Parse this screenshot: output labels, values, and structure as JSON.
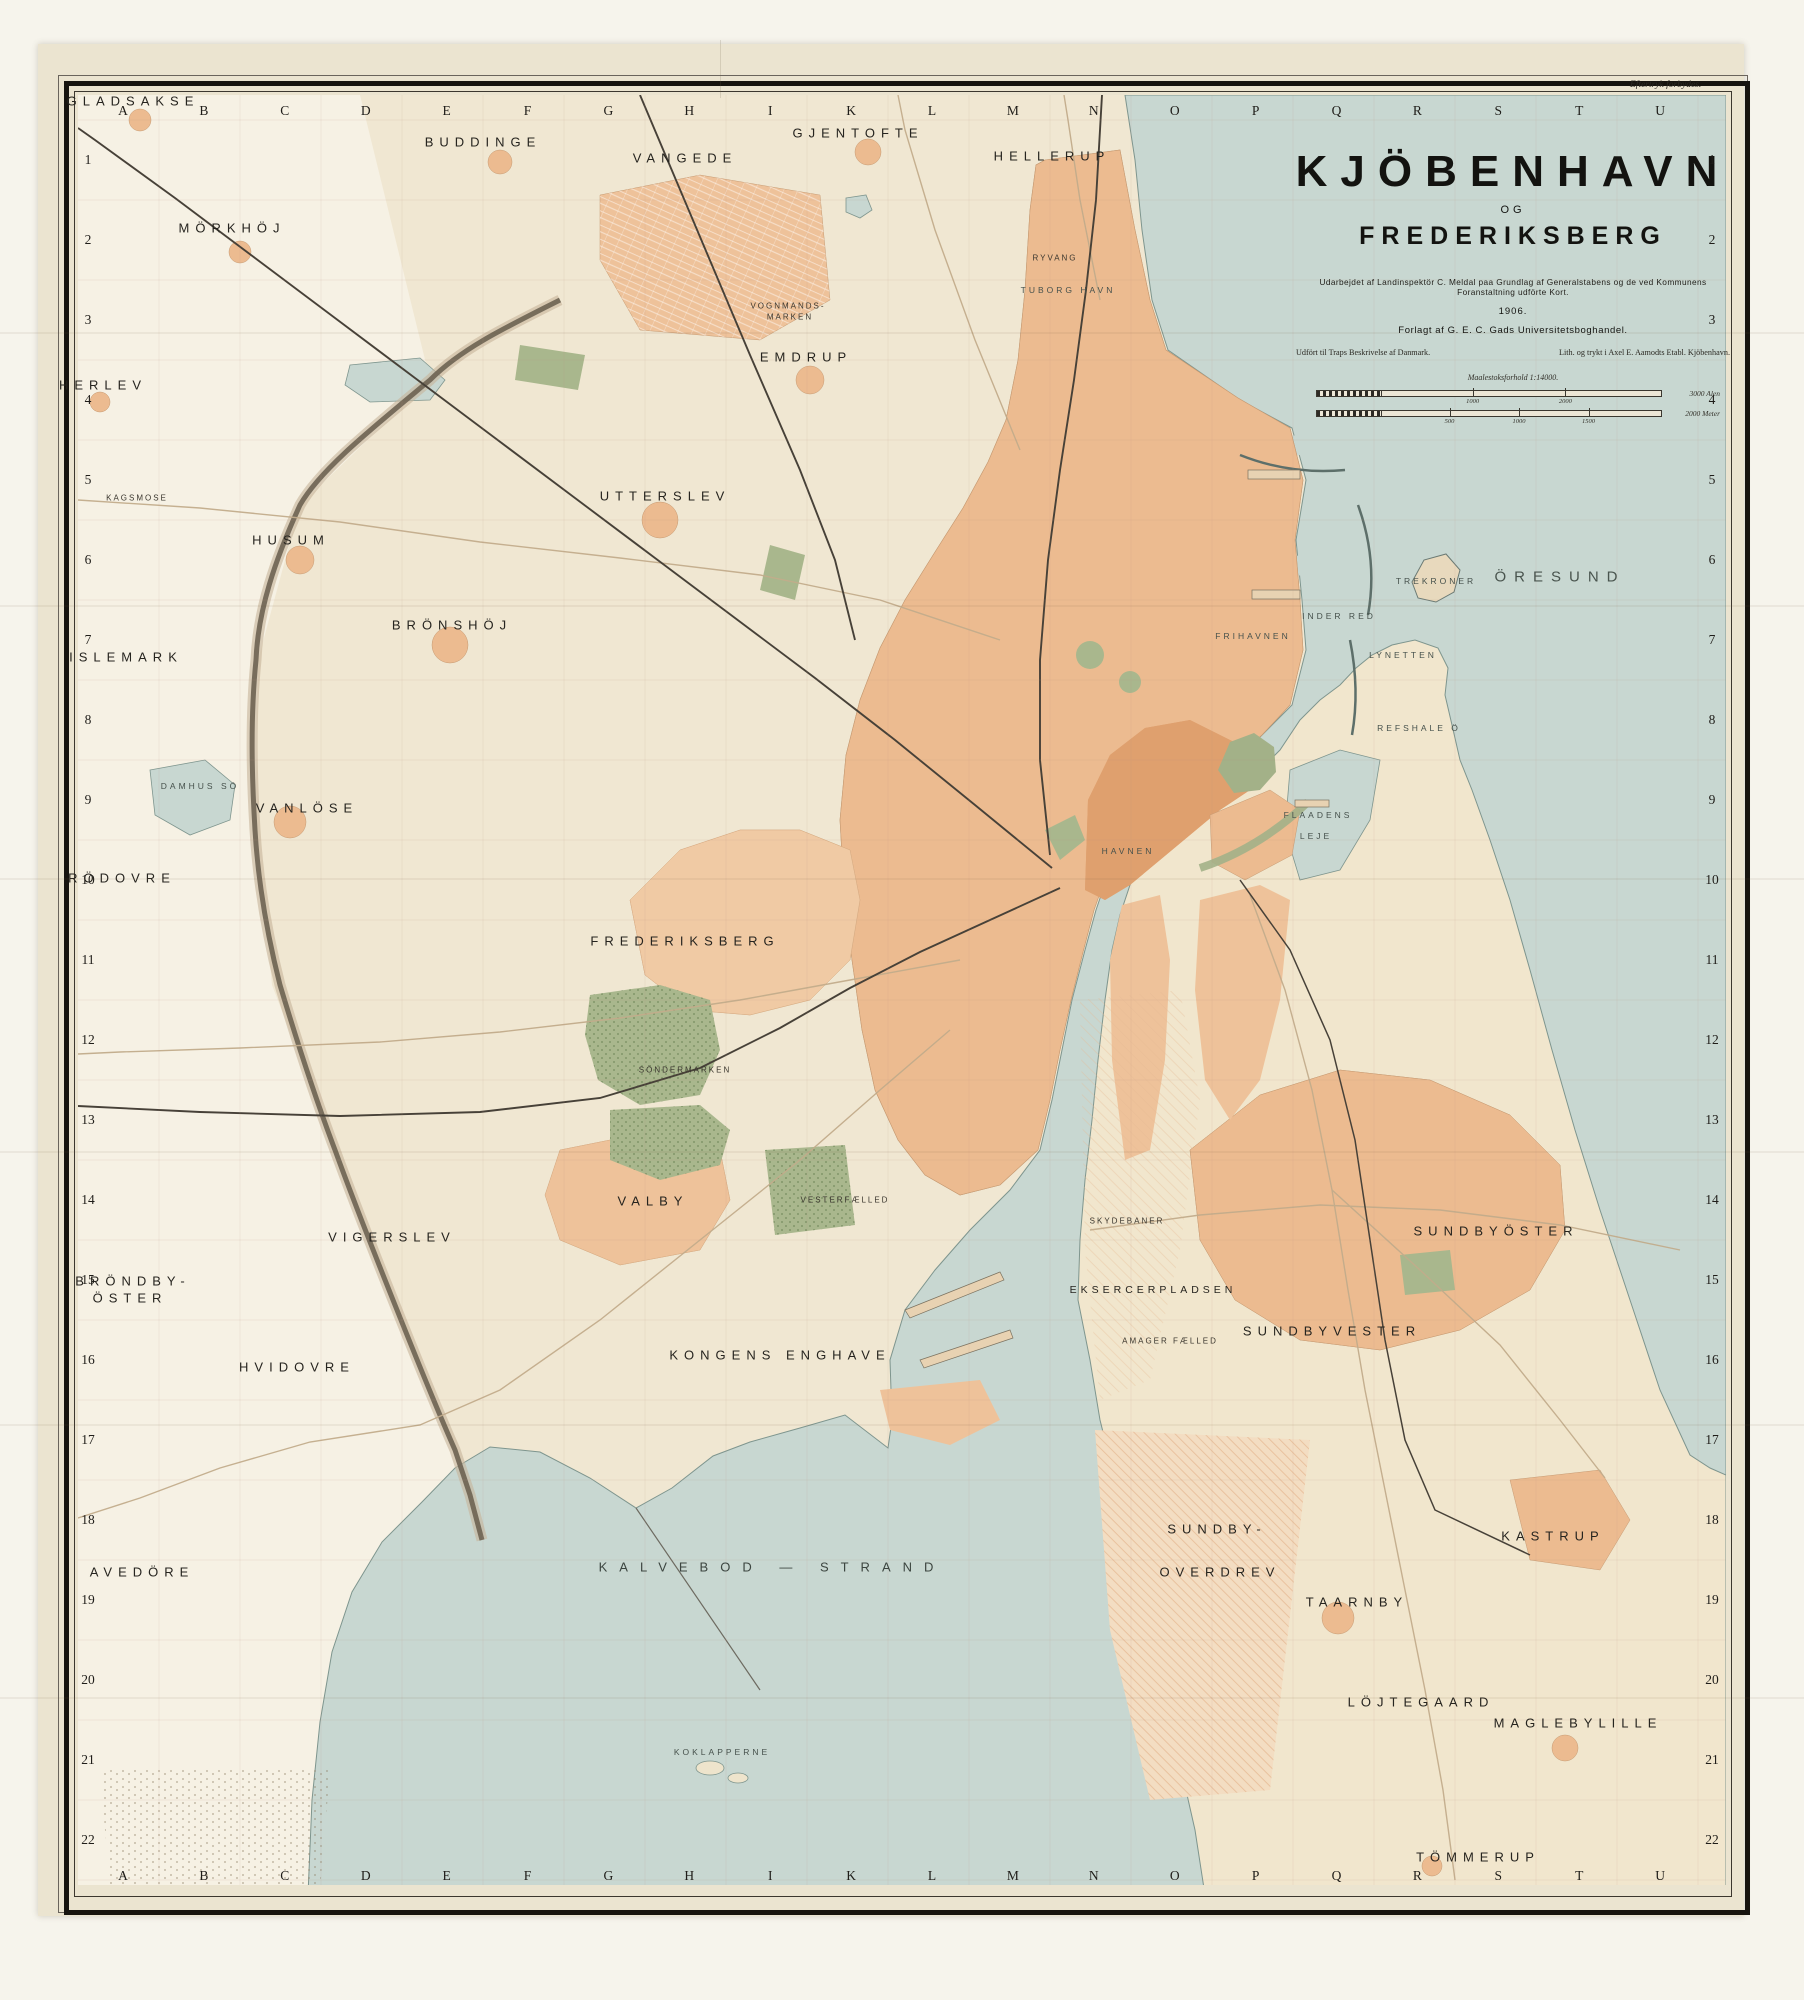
{
  "page": {
    "imprint_top_right": "Eftertryk forbydes."
  },
  "title_block": {
    "title": "KJÖBENHAVN",
    "conjunction": "OG",
    "subtitle": "FREDERIKSBERG",
    "credit_line": "Udarbejdet af Landinspektör C. Meldal paa Grundlag af Generalstabens og de ved Kommunens Foranstaltning udförte Kort.",
    "year": "1906.",
    "publisher": "Forlagt af G. E. C. Gads Universitetsboghandel.",
    "note_left": "Udfört til Traps Beskrivelse af Danmark.",
    "note_right": "Lith. og trykt i Axel E. Aamodts Etabl. Kjöbenhavn.",
    "scale_caption": "Maalestoksforhold 1:14000.",
    "scale_bars": [
      {
        "ticks": [
          "1000",
          "2000"
        ],
        "end_label": "3000 Alen"
      },
      {
        "ticks": [
          "500",
          "1000",
          "1500"
        ],
        "end_label": "2000 Meter"
      }
    ]
  },
  "map": {
    "grid_letters": [
      "A",
      "B",
      "C",
      "D",
      "E",
      "F",
      "G",
      "H",
      "I",
      "K",
      "L",
      "M",
      "N",
      "O",
      "P",
      "Q",
      "R",
      "S",
      "T",
      "U"
    ],
    "row_numbers": [
      "1",
      "2",
      "3",
      "4",
      "5",
      "6",
      "7",
      "8",
      "9",
      "10",
      "11",
      "12",
      "13",
      "14",
      "15",
      "16",
      "17",
      "18",
      "19",
      "20",
      "21",
      "22"
    ],
    "labels": [
      {
        "t": "GLADSAKSE",
        "x": 133,
        "y": 101,
        "c": "lg"
      },
      {
        "t": "BUDDINGE",
        "x": 483,
        "y": 142,
        "c": "lg"
      },
      {
        "t": "VANGEDE",
        "x": 685,
        "y": 158,
        "c": "lg"
      },
      {
        "t": "GJENTOFTE",
        "x": 858,
        "y": 133,
        "c": "lg"
      },
      {
        "t": "HELLERUP",
        "x": 1052,
        "y": 156,
        "c": "lg"
      },
      {
        "t": "MÖRKHÖJ",
        "x": 232,
        "y": 228,
        "c": "lg"
      },
      {
        "t": "EMDRUP",
        "x": 806,
        "y": 357,
        "c": "lg"
      },
      {
        "t": "HERLEV",
        "x": 103,
        "y": 385,
        "c": "lg"
      },
      {
        "t": "UTTERSLEV",
        "x": 665,
        "y": 496,
        "c": "lg"
      },
      {
        "t": "HUSUM",
        "x": 291,
        "y": 540,
        "c": "lg"
      },
      {
        "t": "BRÖNSHÖJ",
        "x": 452,
        "y": 625,
        "c": "lg"
      },
      {
        "t": "ISLEMARK",
        "x": 126,
        "y": 657,
        "c": "lg"
      },
      {
        "t": "VANLÖSE",
        "x": 307,
        "y": 808,
        "c": "lg"
      },
      {
        "t": "RÖDOVRE",
        "x": 122,
        "y": 878,
        "c": "lg"
      },
      {
        "t": "FREDERIKSBERG",
        "x": 685,
        "y": 941,
        "c": "lg"
      },
      {
        "t": "VALBY",
        "x": 653,
        "y": 1201,
        "c": "lg"
      },
      {
        "t": "VIGERSLEV",
        "x": 392,
        "y": 1237,
        "c": "lg"
      },
      {
        "t": "BRÖNDBY-",
        "x": 133,
        "y": 1281,
        "c": "lg"
      },
      {
        "t": "ÖSTER",
        "x": 130,
        "y": 1298,
        "c": "lg"
      },
      {
        "t": "HVIDOVRE",
        "x": 297,
        "y": 1367,
        "c": "lg"
      },
      {
        "t": "KONGENS ENGHAVE",
        "x": 780,
        "y": 1355,
        "c": "lg"
      },
      {
        "t": "AVEDÖRE",
        "x": 142,
        "y": 1572,
        "c": "lg"
      },
      {
        "t": "EKSERCERPLADSEN",
        "x": 1153,
        "y": 1290,
        "c": "md"
      },
      {
        "t": "SUNDBYVESTER",
        "x": 1332,
        "y": 1331,
        "c": "lg"
      },
      {
        "t": "SUNDBYÖSTER",
        "x": 1496,
        "y": 1231,
        "c": "lg"
      },
      {
        "t": "SUNDBY-",
        "x": 1217,
        "y": 1529,
        "c": "lg"
      },
      {
        "t": "OVERDREV",
        "x": 1220,
        "y": 1572,
        "c": "lg"
      },
      {
        "t": "TAARNBY",
        "x": 1357,
        "y": 1602,
        "c": "lg"
      },
      {
        "t": "KASTRUP",
        "x": 1553,
        "y": 1536,
        "c": "lg"
      },
      {
        "t": "LÖJTEGAARD",
        "x": 1421,
        "y": 1702,
        "c": "lg"
      },
      {
        "t": "MAGLEBYLILLE",
        "x": 1578,
        "y": 1723,
        "c": "lg"
      },
      {
        "t": "TÖMMERUP",
        "x": 1478,
        "y": 1857,
        "c": "lg"
      },
      {
        "t": "ÖRESUND",
        "x": 1560,
        "y": 577,
        "c": "wx"
      },
      {
        "t": "KALVEBOD — STRAND",
        "x": 772,
        "y": 1567,
        "c": "wl"
      },
      {
        "t": "TREKRONER",
        "x": 1436,
        "y": 581,
        "c": "ws"
      },
      {
        "t": "INDER RED",
        "x": 1339,
        "y": 616,
        "c": "ws"
      },
      {
        "t": "LYNETTEN",
        "x": 1403,
        "y": 655,
        "c": "ws"
      },
      {
        "t": "REFSHALE Ö",
        "x": 1419,
        "y": 728,
        "c": "ws"
      },
      {
        "t": "FRIHAVNEN",
        "x": 1253,
        "y": 636,
        "c": "ws"
      },
      {
        "t": "FLAADENS",
        "x": 1318,
        "y": 815,
        "c": "ws"
      },
      {
        "t": "LEJE",
        "x": 1316,
        "y": 836,
        "c": "ws"
      },
      {
        "t": "HAVNEN",
        "x": 1128,
        "y": 851,
        "c": "ws"
      },
      {
        "t": "TUBORG HAVN",
        "x": 1068,
        "y": 290,
        "c": "ws"
      },
      {
        "t": "DAMHUS SÖ",
        "x": 200,
        "y": 786,
        "c": "ws"
      },
      {
        "t": "KOKLAPPERNE",
        "x": 722,
        "y": 1752,
        "c": "ws"
      },
      {
        "t": "AMAGER FÆLLED",
        "x": 1170,
        "y": 1341,
        "c": "sm"
      },
      {
        "t": "SKYDEBANER",
        "x": 1127,
        "y": 1221,
        "c": "sm"
      },
      {
        "t": "VESTERFÆLLED",
        "x": 845,
        "y": 1200,
        "c": "sm"
      },
      {
        "t": "SÖNDERMARKEN",
        "x": 685,
        "y": 1070,
        "c": "sm"
      },
      {
        "t": "KAGSMOSE",
        "x": 137,
        "y": 498,
        "c": "sm"
      },
      {
        "t": "VOGNMANDS-",
        "x": 788,
        "y": 306,
        "c": "sm"
      },
      {
        "t": "MARKEN",
        "x": 790,
        "y": 317,
        "c": "sm"
      },
      {
        "t": "RYVANG",
        "x": 1055,
        "y": 258,
        "c": "sm"
      }
    ]
  },
  "colors": {
    "paper": "#ebe4d0",
    "land": "#f0e7d2",
    "water": "#c8d7d1",
    "urban": "#ecbb90",
    "dense_urban": "#dfa06e",
    "park": "#a9b78d",
    "rail": "#474138",
    "frame": "#17140f"
  }
}
